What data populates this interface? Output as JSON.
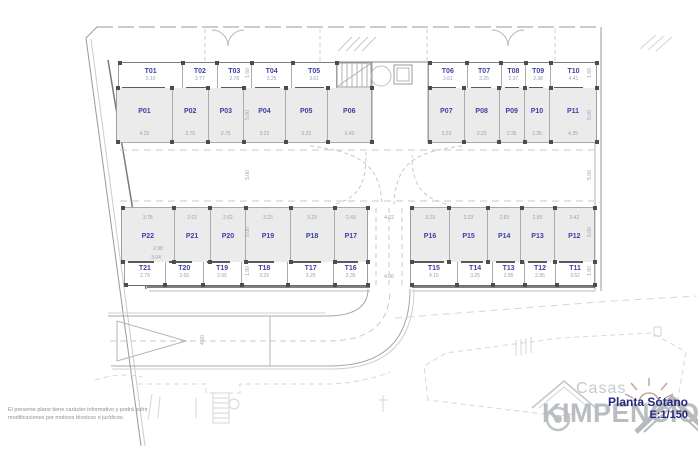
{
  "title_block": {
    "title": "Planta Sótano",
    "scale": "E:1/150"
  },
  "logo": {
    "tagline": "Casas",
    "name": "KIMPENCIO"
  },
  "disclaimer": {
    "line1": "El presente plano tiene carácter informativo y podrá sufrir",
    "line2": "modificaciones por motivos técnicos o jurídicos."
  },
  "colors": {
    "stall_label": "#3f3fa3",
    "dimension_text": "#98a0b4",
    "stall_fill": "#ebebeb",
    "wall_dark": "#5a5a5a",
    "line_light": "#c8c8c8",
    "brand_navy": "#23297d",
    "logo_gray": "#b9bdc0",
    "sun_tint": "#c8a49e"
  },
  "plan": {
    "blocks": [
      {
        "cls": "ttop",
        "x": 118,
        "y": 62,
        "w": 219,
        "h": 26,
        "markers": "top",
        "bar": "bottom",
        "cells": [
          {
            "id": "T01",
            "dim": "5.10"
          },
          {
            "id": "T02",
            "dim": "2.77"
          },
          {
            "id": "T03",
            "dim": "2.78"
          },
          {
            "id": "T04",
            "dim": "3.25"
          },
          {
            "id": "T05",
            "dim": "3.61"
          }
        ]
      },
      {
        "cls": "ttop",
        "x": 428,
        "y": 62,
        "w": 169,
        "h": 26,
        "markers": "top",
        "bar": "bottom",
        "cells": [
          {
            "id": "T06",
            "dim": "3.61"
          },
          {
            "id": "T07",
            "dim": "3.25"
          },
          {
            "id": "T08",
            "dim": "2.37"
          },
          {
            "id": "T09",
            "dim": "2.38"
          },
          {
            "id": "T10",
            "dim": "4.41"
          }
        ]
      },
      {
        "cls": "ptop",
        "x": 116,
        "y": 88,
        "w": 256,
        "h": 55,
        "markers": "both",
        "bar": "",
        "cells": [
          {
            "id": "P01",
            "dim": "4.25"
          },
          {
            "id": "P02",
            "dim": "2.75"
          },
          {
            "id": "P03",
            "dim": "2.75"
          },
          {
            "id": "P04",
            "dim": "3.23"
          },
          {
            "id": "P05",
            "dim": "3.23"
          },
          {
            "id": "P06",
            "dim": "3.43"
          }
        ]
      },
      {
        "cls": "ptop",
        "x": 428,
        "y": 88,
        "w": 169,
        "h": 55,
        "markers": "both",
        "bar": "",
        "cells": [
          {
            "id": "P07",
            "dim": "3.23"
          },
          {
            "id": "P08",
            "dim": "3.23"
          },
          {
            "id": "P09",
            "dim": "2.35"
          },
          {
            "id": "P10",
            "dim": "2.35"
          },
          {
            "id": "P11",
            "dim": "4.35"
          }
        ]
      },
      {
        "cls": "pbot",
        "x": 121,
        "y": 207,
        "w": 247,
        "h": 55,
        "markers": "both",
        "bar": "",
        "cells": [
          {
            "id": "P22",
            "dim": "3.78"
          },
          {
            "id": "P21",
            "dim": "2.62"
          },
          {
            "id": "P20",
            "dim": "2.62"
          },
          {
            "id": "P19",
            "dim": "3.23"
          },
          {
            "id": "P18",
            "dim": "3.23"
          },
          {
            "id": "P17",
            "dim": "2.43"
          }
        ]
      },
      {
        "cls": "pbot",
        "x": 410,
        "y": 207,
        "w": 185,
        "h": 55,
        "markers": "both",
        "bar": "",
        "cells": [
          {
            "id": "P16",
            "dim": "3.23"
          },
          {
            "id": "P15",
            "dim": "3.23"
          },
          {
            "id": "P14",
            "dim": "2.83"
          },
          {
            "id": "P13",
            "dim": "2.83"
          },
          {
            "id": "P12",
            "dim": "3.42"
          }
        ]
      },
      {
        "cls": "tbot",
        "x": 124,
        "y": 262,
        "w": 244,
        "h": 24,
        "markers": "bottom",
        "bar": "top",
        "cells": [
          {
            "id": "T21",
            "dim": "2.79"
          },
          {
            "id": "T20",
            "dim": "2.65"
          },
          {
            "id": "T19",
            "dim": "2.65"
          },
          {
            "id": "T18",
            "dim": "3.25"
          },
          {
            "id": "T17",
            "dim": "3.25"
          },
          {
            "id": "T16",
            "dim": "2.35"
          }
        ]
      },
      {
        "cls": "tbot",
        "x": 410,
        "y": 262,
        "w": 185,
        "h": 24,
        "markers": "bottom",
        "bar": "top",
        "cells": [
          {
            "id": "T15",
            "dim": "4.15"
          },
          {
            "id": "T14",
            "dim": "3.25"
          },
          {
            "id": "T13",
            "dim": "2.85"
          },
          {
            "id": "T12",
            "dim": "2.85"
          },
          {
            "id": "T11",
            "dim": "3.52"
          }
        ]
      }
    ],
    "floating_dims": [
      {
        "t": "2.98",
        "x": 158,
        "y": 249,
        "r": 0
      },
      {
        "t": "3.04",
        "x": 156,
        "y": 258,
        "r": 0
      },
      {
        "t": "4.02",
        "x": 389,
        "y": 218,
        "r": 0
      },
      {
        "t": "4.06",
        "x": 389,
        "y": 277,
        "r": 0
      },
      {
        "t": "4.00",
        "x": 203,
        "y": 340,
        "r": 1
      },
      {
        "t": "1.60",
        "x": 248,
        "y": 73,
        "r": 1
      },
      {
        "t": "5.00",
        "x": 248,
        "y": 115,
        "r": 1
      },
      {
        "t": "5.00",
        "x": 248,
        "y": 175,
        "r": 1
      },
      {
        "t": "5.00",
        "x": 248,
        "y": 232,
        "r": 1
      },
      {
        "t": "1.80",
        "x": 248,
        "y": 271,
        "r": 1
      },
      {
        "t": "1.60",
        "x": 590,
        "y": 73,
        "r": 1
      },
      {
        "t": "5.00",
        "x": 590,
        "y": 115,
        "r": 1
      },
      {
        "t": "5.00",
        "x": 590,
        "y": 175,
        "r": 1
      },
      {
        "t": "5.00",
        "x": 590,
        "y": 232,
        "r": 1
      },
      {
        "t": "1.80",
        "x": 590,
        "y": 271,
        "r": 1
      }
    ]
  }
}
